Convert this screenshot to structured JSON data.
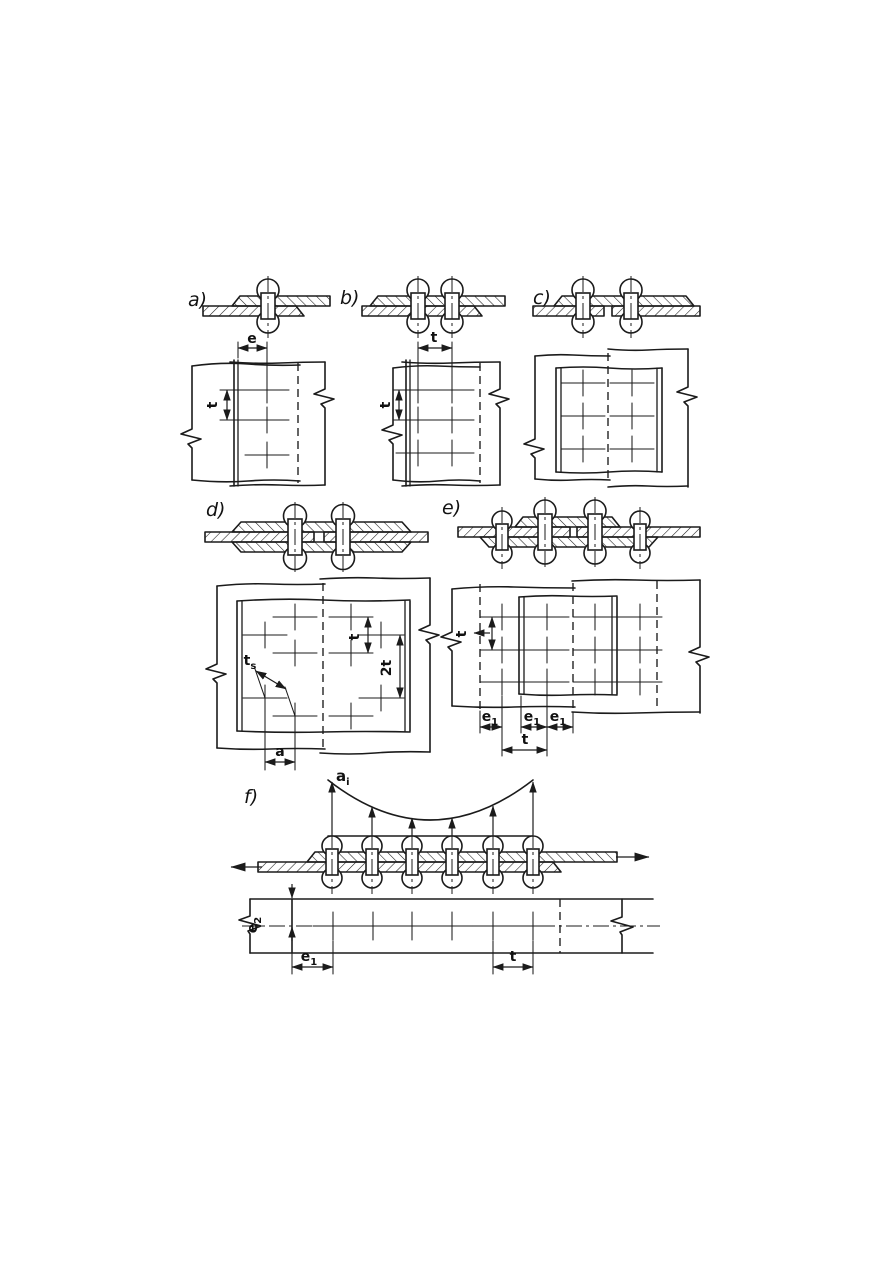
{
  "document": {
    "background": "#ffffff",
    "ink": "#1b1b1b",
    "description": "Riveted joint configurations, cross-sections and plan views"
  },
  "figures": {
    "a": {
      "label": "a)",
      "dim_edge_top": "e",
      "dim_pitch_left": "t"
    },
    "b": {
      "label": "b)",
      "dim_pitch_top": "t",
      "dim_pitch_left": "t"
    },
    "c": {
      "label": "c)"
    },
    "d": {
      "label": "d)",
      "dim_diagonal": {
        "base": "t",
        "sub": "s"
      },
      "dim_pitch": "t",
      "dim_double_pitch": "2t",
      "dim_stagger": "a"
    },
    "e": {
      "label": "e)",
      "dim_pitch_left": "t",
      "dim_edge_a": {
        "base": "e",
        "sub": "1"
      },
      "dim_edge_b": {
        "base": "e",
        "sub": "1"
      },
      "dim_edge_c": {
        "base": "e",
        "sub": "1"
      },
      "dim_pitch_bottom": "t"
    },
    "f": {
      "label": "f)",
      "load_label": {
        "base": "a",
        "sub": "i"
      },
      "dim_edge_side": {
        "base": "e",
        "sub": "2"
      },
      "dim_edge_end": {
        "base": "e",
        "sub": "1"
      },
      "dim_pitch": "t"
    }
  }
}
